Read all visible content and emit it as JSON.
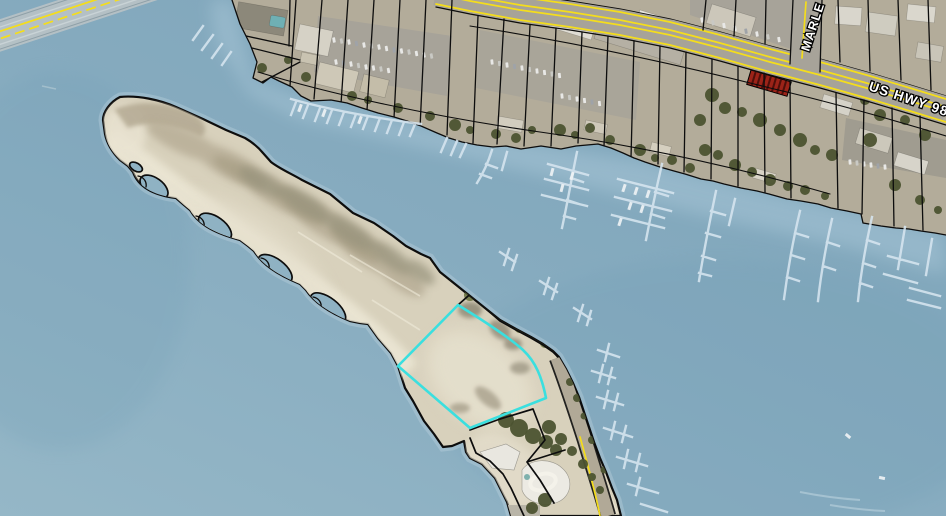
{
  "labels": {
    "us_hwy_98": "US HWY 98",
    "marler_st": "MARLE"
  },
  "selected_parcel": {
    "outline_color": "#3adfdf"
  },
  "colors": {
    "water": "#86abbf",
    "water_deep": "#6f9cb4",
    "water_light": "#95b7c7",
    "shallow": "#aecbdb",
    "sand": "#d8d1bc",
    "sand_bright": "#ebe5d3",
    "dune": "#b3a992",
    "scrub": "#97937c",
    "veg": "#4c5330",
    "veg_light": "#6e7442",
    "mainland": "#b3ac9a",
    "asphalt": "#a7a399",
    "parcel_line": "#0d0d0d",
    "selected_parcel": "#3adfdf",
    "road_yellow": "#f4dd1c",
    "dock": "#d6e5ef",
    "boat": "#eff3f5",
    "bridge": "#b9c2c6",
    "red_roof": "#9c2318",
    "label_text": "#ffffff",
    "label_halo": "#000000"
  }
}
